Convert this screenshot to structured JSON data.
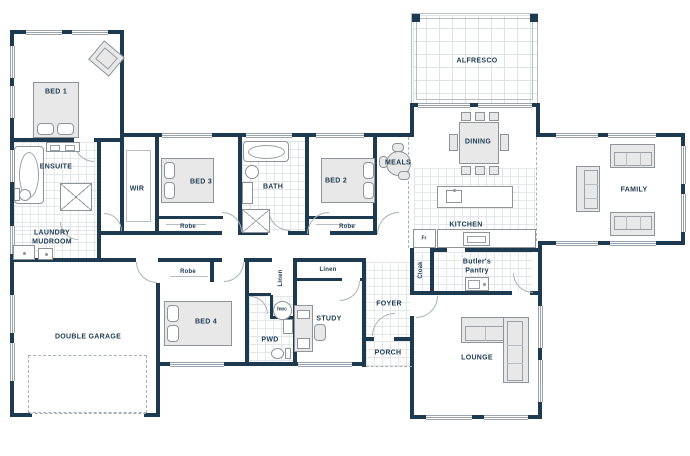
{
  "plan_type": "residential floor plan",
  "colors": {
    "wall": "#1d3a50",
    "label_text": "#1d3a50",
    "furniture_fill": "#e8e8e8",
    "furniture_outline": "#8f9499",
    "tile_line": "#e3e7ea",
    "window_line": "#9aa4ac",
    "background": "#ffffff"
  },
  "labels": {
    "bed1": "BED 1",
    "ensuite": "ENSUITE",
    "laundry": "LAUNDRY\nMUDROOM",
    "wir": "WIR",
    "bed3": "BED 3",
    "robe_bed3": "Robe",
    "bath": "BATH",
    "bed2": "BED 2",
    "robe_bed2": "Robe",
    "meals": "MEALS",
    "alfresco": "ALFRESCO",
    "dining": "DINING",
    "kitchen": "KITCHEN",
    "fridge": "Fr",
    "cloak": "Cloak",
    "butlers_pantry": "Butler's\nPantry",
    "family": "FAMILY",
    "double_garage": "DOUBLE GARAGE",
    "robe_bed4": "Robe",
    "bed4": "BED 4",
    "linen_hall": "Linen",
    "hwc": "hwc",
    "linen_study": "Linen",
    "pwd": "PWD",
    "study": "STUDY",
    "foyer": "FOYER",
    "porch": "PORCH",
    "lounge": "LOUNGE"
  }
}
